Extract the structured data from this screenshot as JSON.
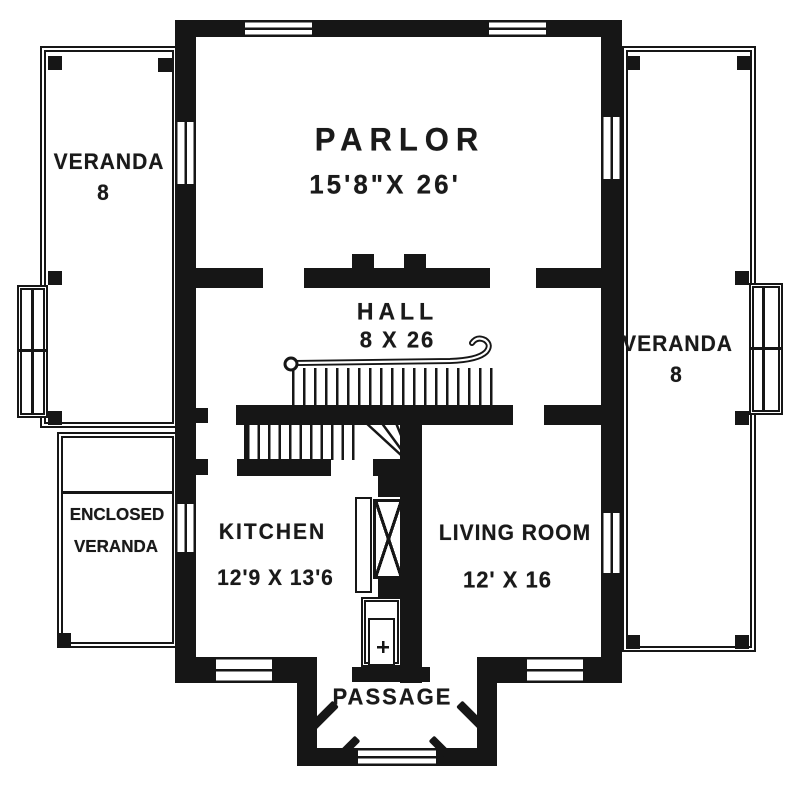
{
  "drawing": {
    "type": "floor-plan"
  },
  "rooms": {
    "parlor": {
      "name": "PARLOR",
      "dims": "15'8\"X 26'"
    },
    "hall": {
      "name": "HALL",
      "dims": "8 X 26"
    },
    "veranda_left": {
      "name": "VERANDA",
      "width": "8"
    },
    "veranda_right": {
      "name": "VERANDA",
      "width": "8"
    },
    "enclosed_veranda": {
      "line1": "ENCLOSED",
      "line2": "VERANDA"
    },
    "kitchen": {
      "name": "KITCHEN",
      "dims": "12'9 X 13'6"
    },
    "living_room": {
      "name": "LIVING ROOM",
      "dims": "12' X 16"
    },
    "passage": {
      "name": "PASSAGE"
    }
  },
  "colors": {
    "ink": "#161616",
    "paper": "#ffffff"
  }
}
